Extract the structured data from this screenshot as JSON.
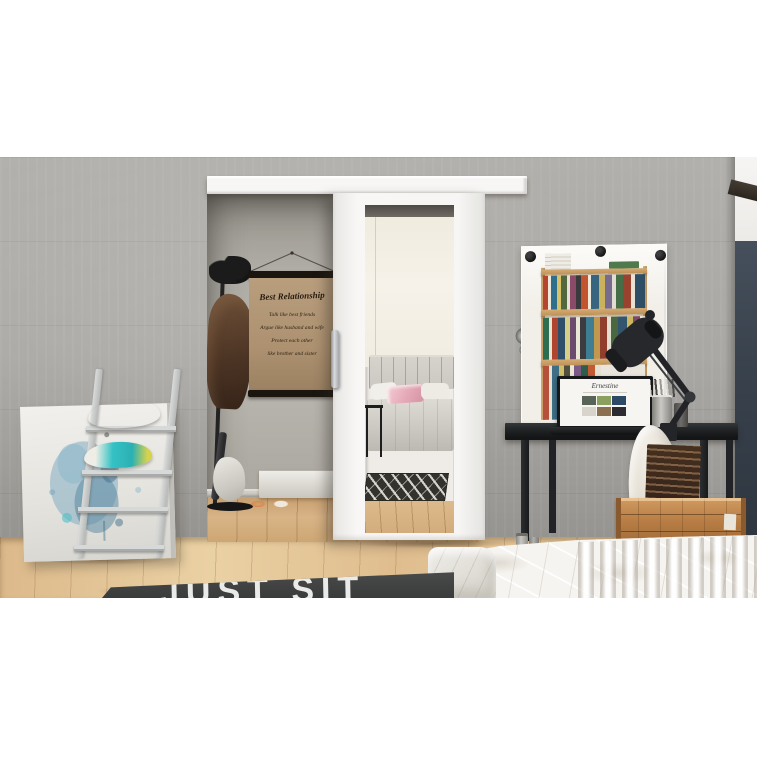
{
  "poster": {
    "title": "Best Relationship",
    "lines": [
      "Talk like best friends",
      "Argue like husband and wife",
      "Protect each other",
      "like brother and sister"
    ]
  },
  "rug": {
    "text": "JUST SIT"
  },
  "laptop": {
    "logo": "Ernestine"
  },
  "palette": {
    "wall": "#a7a5a1",
    "interior_wall": "#b2afa8",
    "door_white": "#f7f6f4",
    "floor_wood": "#e2c294",
    "rug_dark": "#3e3f3f",
    "rug_text": "#eaeae8",
    "desk_black": "#1f2124",
    "accent_wall_right": "#39424d",
    "poster_canvas": "#b2966f",
    "poster_frame": "#1b150f",
    "crate_wood": "#b77d45",
    "pillow_teal": "#35c2c5",
    "pillow_yellow": "#d9d44e",
    "canvas_paint_blue": "#6f9fba",
    "bed_white": "#f6f4f0",
    "coat_brown": "#4d3525",
    "chair_white": "#e9e4d9"
  }
}
